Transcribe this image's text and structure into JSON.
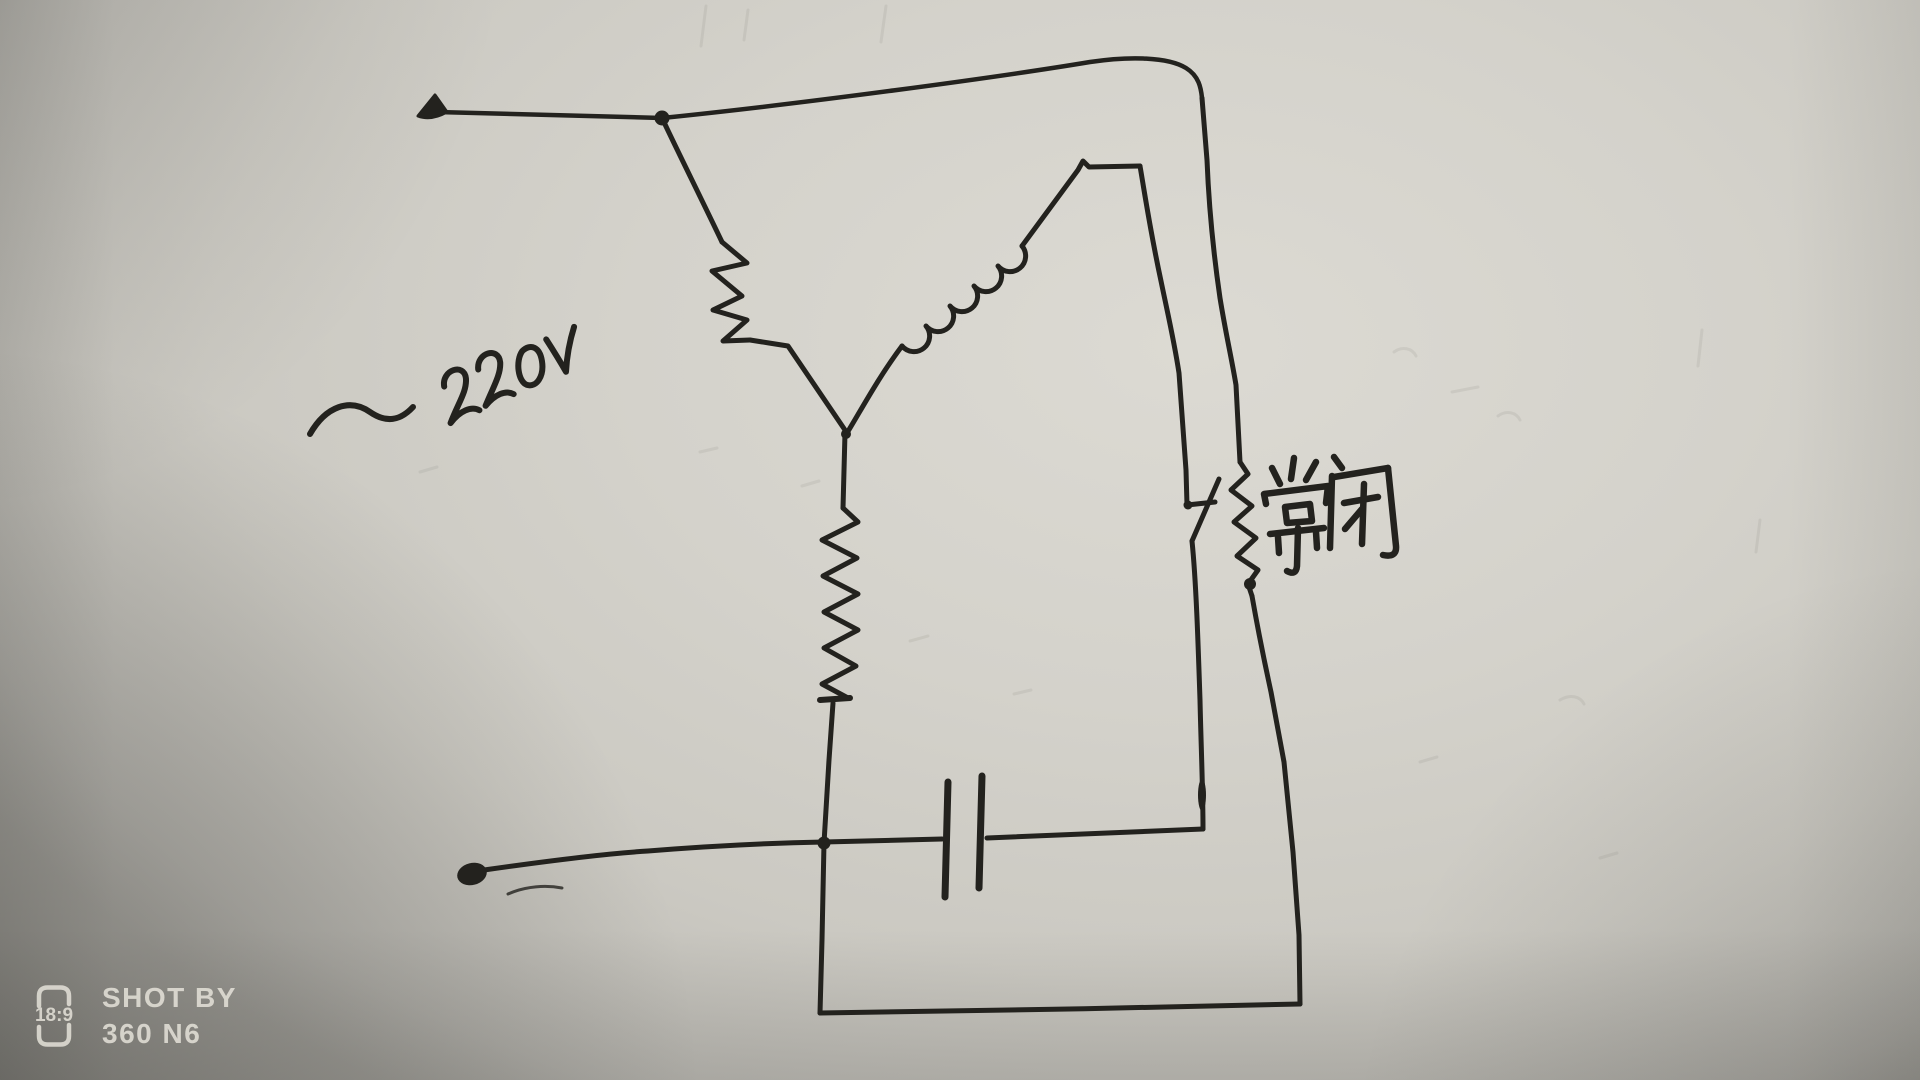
{
  "diagram": {
    "voltage_label": "~220V",
    "contact_label": "常闭",
    "ink_color": "#23221e",
    "paper_color": "#d2d0c9",
    "components": [
      {
        "name": "ac-source-terminal-top",
        "shape": "filled-arrow-dot"
      },
      {
        "name": "ac-source-terminal-bottom",
        "shape": "filled-dot"
      },
      {
        "name": "main-winding",
        "shape": "diagonal-zigzag"
      },
      {
        "name": "start-winding",
        "shape": "diagonal-loop-coil"
      },
      {
        "name": "run-winding",
        "shape": "vertical-zigzag"
      },
      {
        "name": "starting-capacitor",
        "shape": "parallel-plates"
      },
      {
        "name": "centrifugal-switch-blade",
        "shape": "knife-blade"
      },
      {
        "name": "normally-closed-contact",
        "shape": "vertical-zigzag"
      }
    ]
  },
  "watermark": {
    "aspect_badge": "18:9",
    "line1": "SHOT BY",
    "line2": "360 N6",
    "color": "#e9e6dd"
  }
}
